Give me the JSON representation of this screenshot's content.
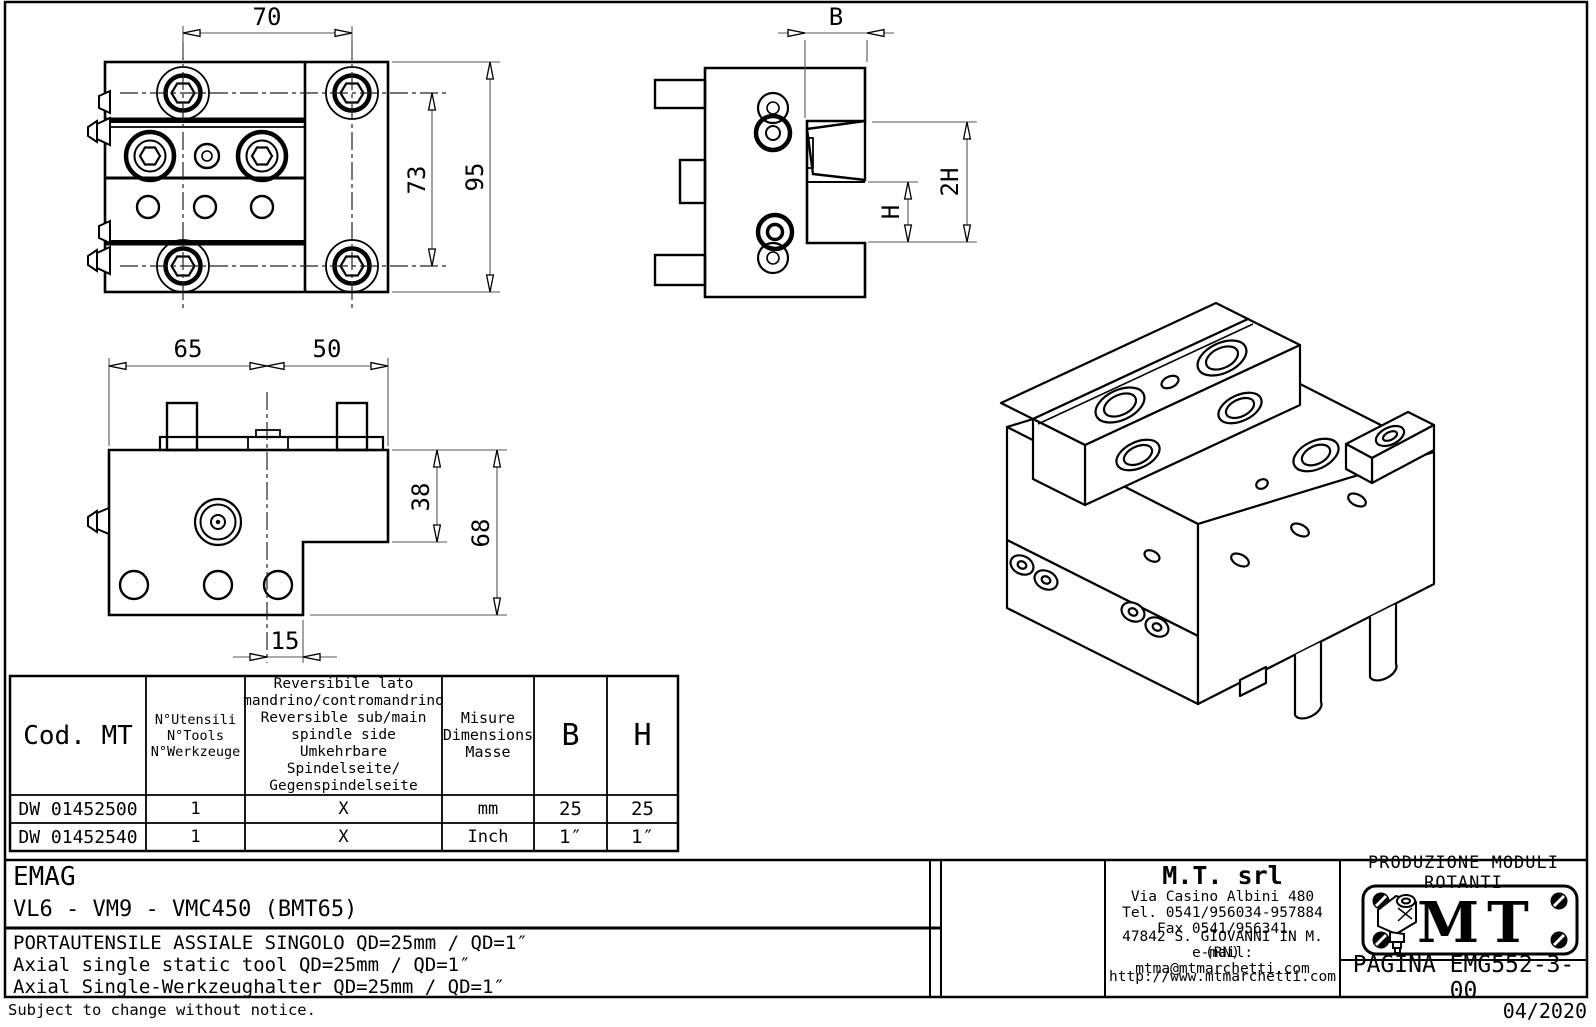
{
  "dims": {
    "front": {
      "top": "70",
      "inner": "73",
      "total": "95"
    },
    "side": {
      "width": "B",
      "h": "H",
      "h2": "2H"
    },
    "bottom": {
      "left": "65",
      "right": "50",
      "step": "38",
      "total": "68",
      "offset": "15"
    }
  },
  "table": {
    "headers": [
      "Cod. MT",
      "N°Utensili\nN°Tools\nN°Werkzeuge",
      "Reversibile lato\nmandrino/contromandrino\nReversible sub/main\nspindle side\nUmkehrbare Spindelseite/\nGegenspindelseite",
      "Misure\nDimensions\nMasse",
      "B",
      "H"
    ],
    "rows": [
      [
        "DW 01452500",
        "1",
        "X",
        "mm",
        "25",
        "25"
      ],
      [
        "DW 01452540",
        "1",
        "X",
        "Inch",
        "1″",
        "1″"
      ]
    ]
  },
  "title_block": {
    "customer": "EMAG",
    "machines": "VL6 - VM9 - VMC450 (BMT65)",
    "description_it": "PORTAUTENSILE ASSIALE SINGOLO QD=25mm / QD=1″",
    "description_en": "Axial single static tool  QD=25mm / QD=1″",
    "description_de": "Axial Single-Werkzeughalter QD=25mm / QD=1″",
    "company": {
      "name": "M.T.  srl",
      "address": "Via Casino Albini 480",
      "phone": "Tel. 0541/956034-957884",
      "fax": "Fax 0541/956341",
      "city": "47842 S. GIOVANNI IN M. (RN)",
      "email": "e-mail: mtma@mtmarchetti.com",
      "website": "http://www.mtmarchetti.com"
    },
    "logo": {
      "tagline": "PRODUZIONE MODULI ROTANTI",
      "text": "MT"
    },
    "page": "PAGINA EMG552-3-00"
  },
  "footer": {
    "note": "Subject to change without notice.",
    "date": "04/2020"
  }
}
